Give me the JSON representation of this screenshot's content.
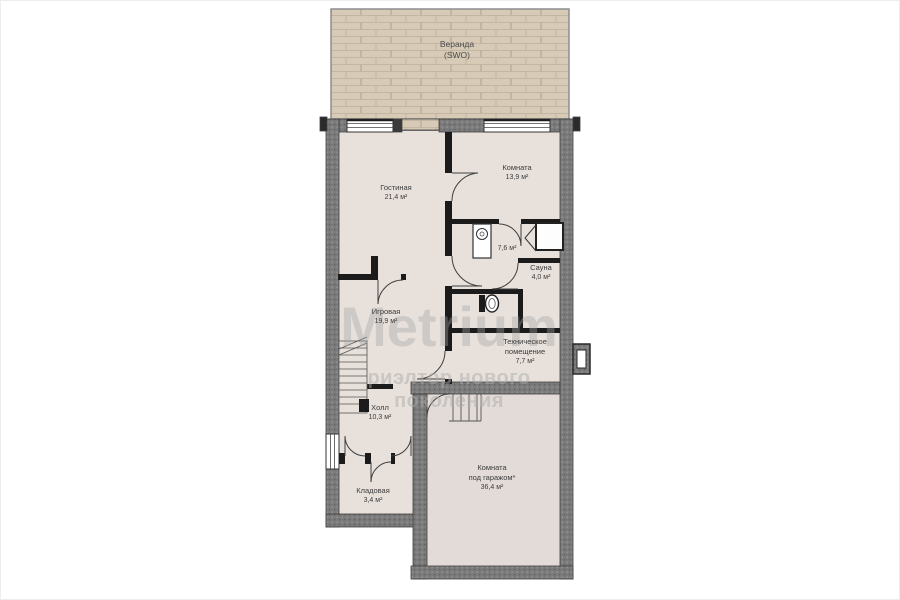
{
  "watermark": {
    "brand": "Metrium",
    "tagline": "риэлтор нового поколения"
  },
  "rooms": {
    "veranda": {
      "name": "Веранда",
      "note": "(SWO)"
    },
    "living": {
      "name": "Гостиная",
      "area": "21,4 м²"
    },
    "bedroom": {
      "name": "Комната",
      "area": "13,9 м²"
    },
    "bathroom": {
      "area": "7,6 м²"
    },
    "sauna": {
      "name": "Сауна",
      "area": "4,0 м²"
    },
    "playroom": {
      "name": "Игровая",
      "area": "19,9 м²"
    },
    "technical": {
      "name_line1": "Техническое",
      "name_line2": "помещение",
      "area": "7,7 м²"
    },
    "hall": {
      "name": "Холл",
      "area": "10,3 м²"
    },
    "storage": {
      "name": "Кладовая",
      "area": "3,4 м²"
    },
    "garage_room": {
      "name_line1": "Комната",
      "name_line2": "под гаражом*",
      "area": "36,4 м²"
    }
  },
  "colors": {
    "veranda_fill": "#d7cab6",
    "veranda_joint": "#bdb09c",
    "exterior_wall": "#7b7b7b",
    "interior_wall": "#1b1b1b",
    "floor": "#e7e0db",
    "garage_floor": "#e2dbd7",
    "watermark": "#bdbdbd"
  }
}
